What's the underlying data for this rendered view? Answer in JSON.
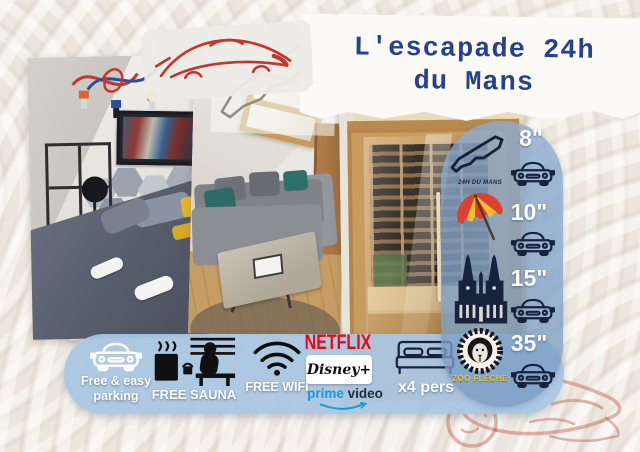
{
  "title": {
    "line1": "L'escapade 24h",
    "line2": "du Mans"
  },
  "distance_panel": {
    "rows": [
      {
        "icon": "lemans-circuit-icon",
        "label": "24H DU MANS",
        "time": "8\""
      },
      {
        "icon": "beach-umbrella-icon",
        "label": "",
        "time": "10\""
      },
      {
        "icon": "cathedral-icon",
        "label": "",
        "time": "15\""
      },
      {
        "icon": "zoo-lion-icon",
        "label": "ZOO FLÈCHE",
        "time": "35\""
      }
    ],
    "car_icon": "car-front-icon"
  },
  "amenities": {
    "parking": {
      "icon": "car-front-icon",
      "line1": "Free & easy",
      "line2": "parking"
    },
    "sauna": {
      "icon": "sauna-icon",
      "label": "FREE SAUNA"
    },
    "wifi": {
      "icon": "wifi-icon",
      "label": "FREE WIFI"
    },
    "netflix": {
      "label": "NETFLIX"
    },
    "disney": {
      "label": "Disney+"
    },
    "prime": {
      "word1": "prime",
      "word2": " video"
    },
    "capacity": {
      "icon": "double-bed-icon",
      "label": "x4 pers"
    }
  },
  "colors": {
    "title_navy": "#24428e",
    "panel_blue": "#aac6e1",
    "icon_navy": "#16233f",
    "zoo_yellow": "#e7c43a",
    "netflix_red": "#e50914",
    "prime_blue": "#1a98d5",
    "background_beige": "#ece6dd"
  }
}
